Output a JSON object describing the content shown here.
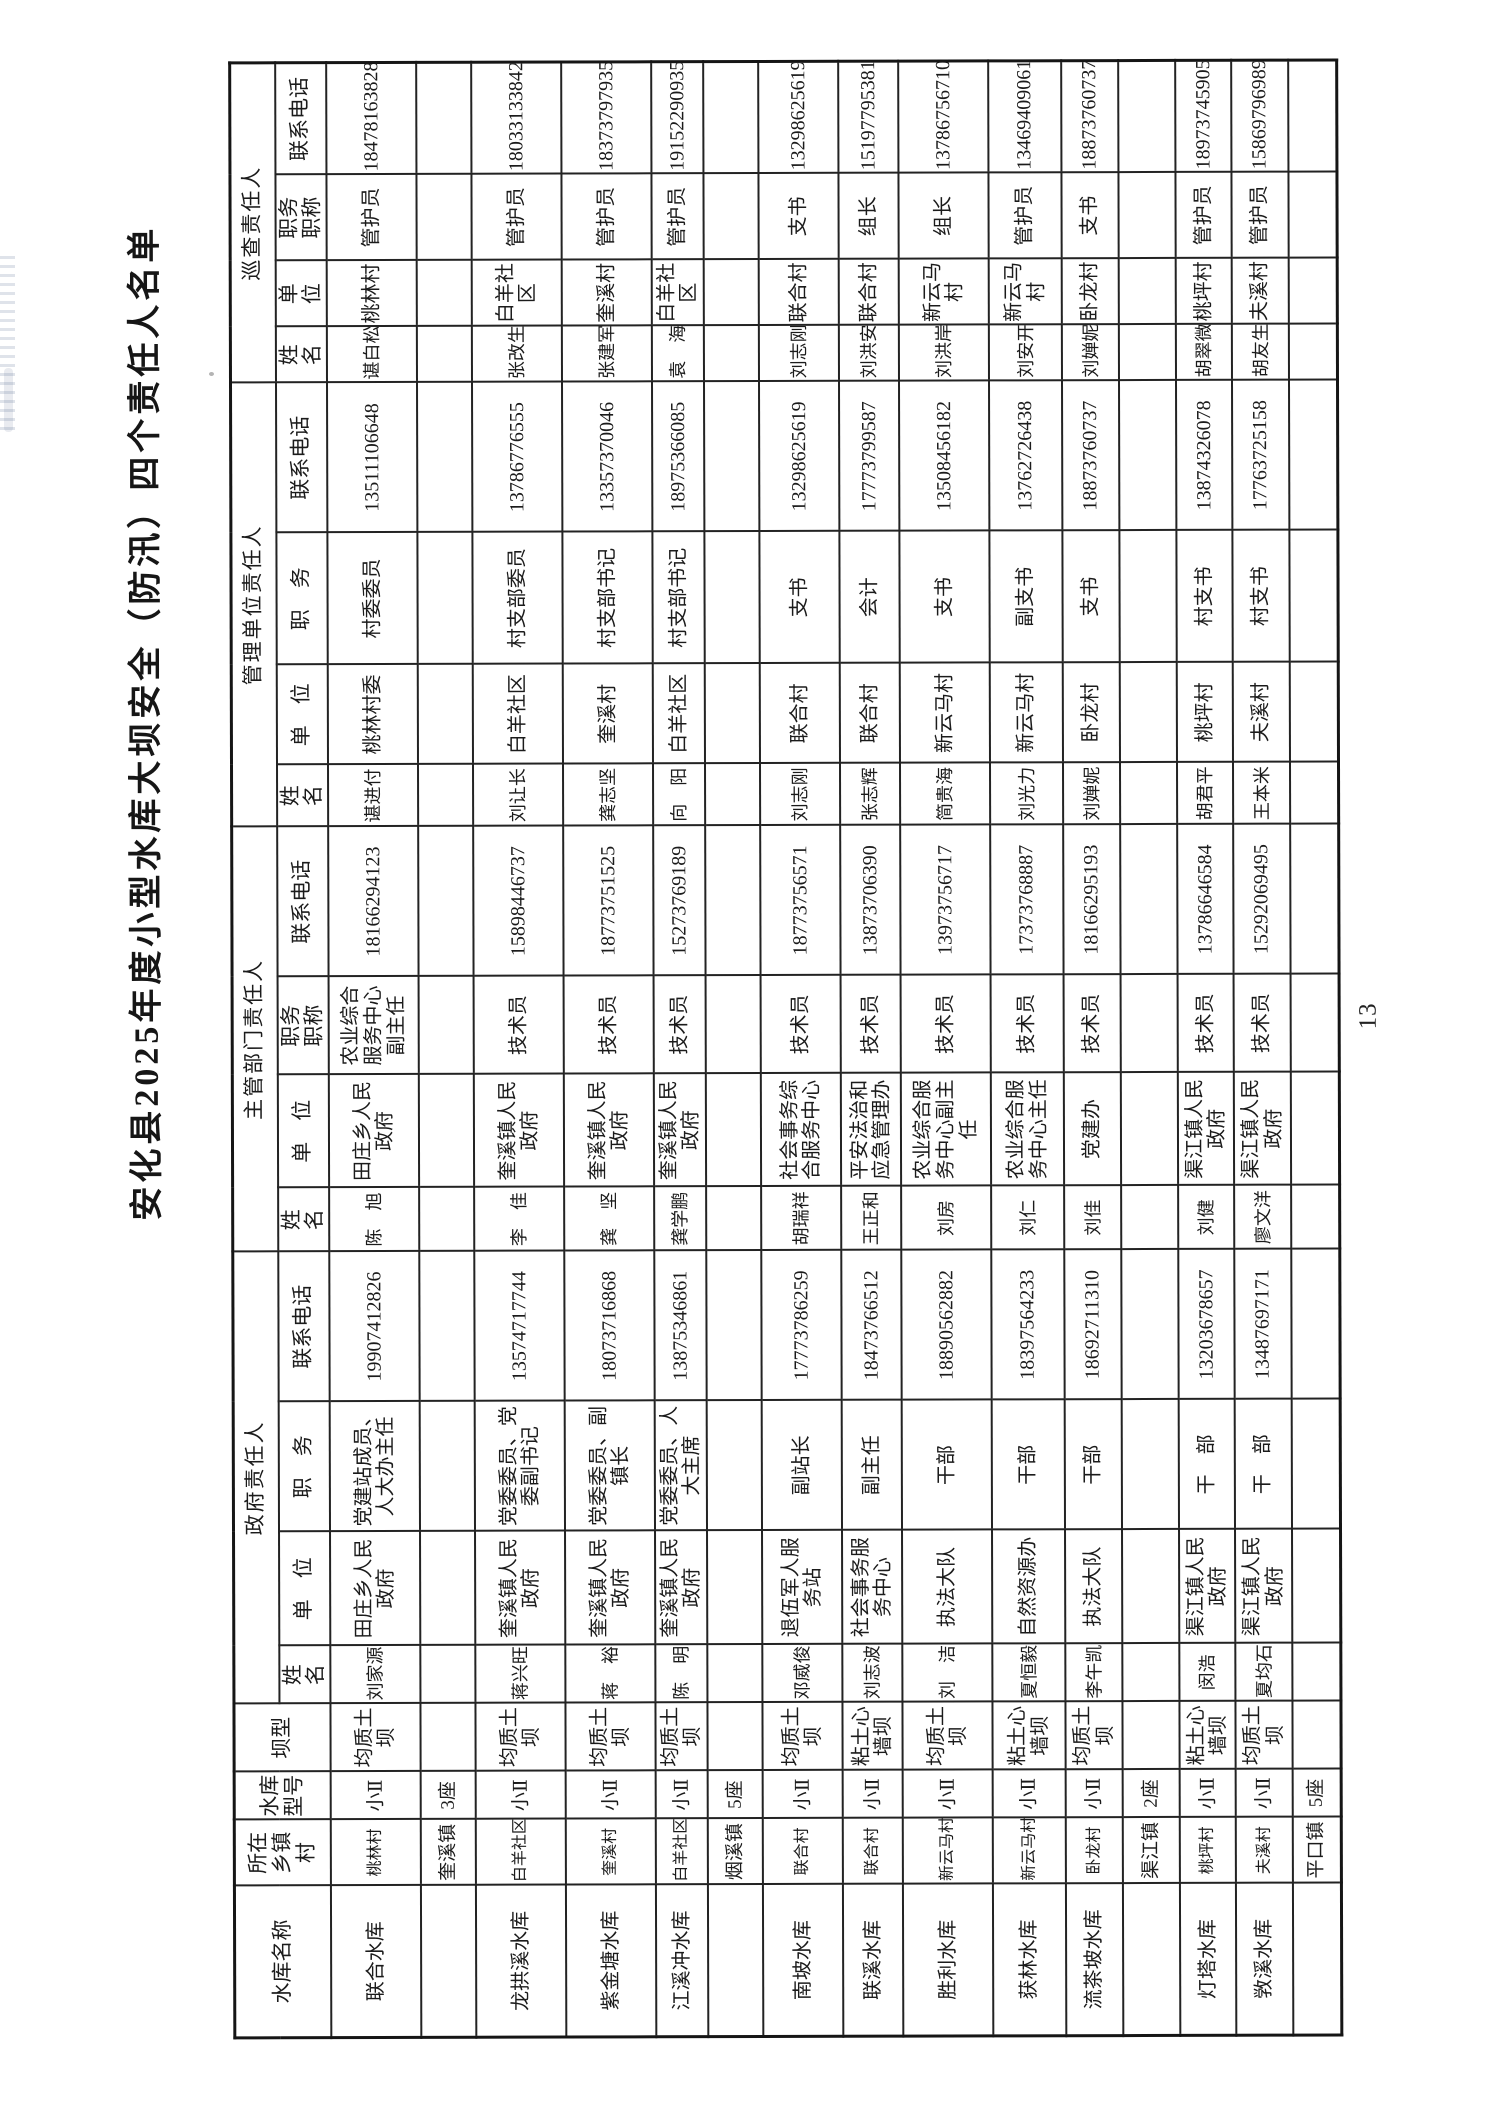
{
  "page": {
    "title": "安化县2025年度小型水库大坝安全（防汛）四个责任人名单",
    "page_number": "13"
  },
  "table": {
    "fixed_headers": [
      "水库名称",
      "所在\n乡镇村",
      "水库\n型号",
      "坝型"
    ],
    "groups": [
      {
        "label": "政府责任人",
        "cols": [
          "姓　名",
          "单　位",
          "职　务",
          "联系电话"
        ]
      },
      {
        "label": "主管部门责任人",
        "cols": [
          "姓　名",
          "单　位",
          "职务\n职称",
          "联系电话"
        ]
      },
      {
        "label": "管理单位责任人",
        "cols": [
          "姓　名",
          "单　位",
          "职　务",
          "联系电话"
        ]
      },
      {
        "label": "巡查责任人",
        "cols": [
          "姓　名",
          "单　位",
          "职务\n职称",
          "联系电话"
        ]
      }
    ],
    "rows": [
      {
        "type": "data",
        "cells": [
          "联合水库",
          "桃林村",
          "小Ⅱ",
          "均质土坝",
          "刘家源",
          "田庄乡人民政府",
          "党建站成员、人大办主任",
          "19907412826",
          "陈　旭",
          "田庄乡人民政府",
          "农业综合服务中心副主任",
          "18166294123",
          "谌进付",
          "桃林村委",
          "村委委员",
          "13511106648",
          "谌白松",
          "桃林村",
          "管护员",
          "18478163828"
        ]
      },
      {
        "type": "group",
        "township": "奎溪镇",
        "count": "3座"
      },
      {
        "type": "data",
        "cells": [
          "龙拱溪水库",
          "白羊社区",
          "小Ⅱ",
          "均质土坝",
          "蒋兴旺",
          "奎溪镇人民政府",
          "党委委员、党委副书记",
          "13574717744",
          "李　佳",
          "奎溪镇人民政府",
          "技术员",
          "15898446737",
          "刘让长",
          "白羊社区",
          "村支部委员",
          "13786776555",
          "张改生",
          "白羊社区",
          "管护员",
          "18033133842"
        ]
      },
      {
        "type": "data",
        "cells": [
          "紫金塘水库",
          "奎溪村",
          "小Ⅱ",
          "均质土坝",
          "蒋　裕",
          "奎溪镇人民政府",
          "党委委员、副镇长",
          "18073716868",
          "龚　坚",
          "奎溪镇人民政府",
          "技术员",
          "18773751525",
          "龚志坚",
          "奎溪村",
          "村支部书记",
          "13357370046",
          "张建军",
          "奎溪村",
          "管护员",
          "18373797935"
        ]
      },
      {
        "type": "data",
        "cells": [
          "江溪冲水库",
          "白羊社区",
          "小Ⅱ",
          "均质土坝",
          "陈　明",
          "奎溪镇人民政府",
          "党委委员、人大主席",
          "13875346861",
          "龚学鹏",
          "奎溪镇人民政府",
          "技术员",
          "15273769189",
          "向　阳",
          "白羊社区",
          "村支部书记",
          "18975366085",
          "袁　海",
          "白羊社区",
          "管护员",
          "19152290935"
        ]
      },
      {
        "type": "group",
        "township": "烟溪镇",
        "count": "5座"
      },
      {
        "type": "data",
        "cells": [
          "南坡水库",
          "联合村",
          "小Ⅱ",
          "均质土坝",
          "邓威俊",
          "退伍军人服务站",
          "副站长",
          "17773786259",
          "胡瑞祥",
          "社会事务综合服务中心",
          "技术员",
          "18773756571",
          "刘志刚",
          "联合村",
          "支书",
          "13298625619",
          "刘志刚",
          "联合村",
          "支书",
          "13298625619"
        ]
      },
      {
        "type": "data",
        "cells": [
          "联溪水库",
          "联合村",
          "小Ⅱ",
          "粘土心墙坝",
          "刘志波",
          "社会事务服务中心",
          "副主任",
          "18473766512",
          "王正和",
          "平安法治和应急管理办",
          "技术员",
          "13873706390",
          "张志辉",
          "联合村",
          "会计",
          "17773799587",
          "刘洪安",
          "联合村",
          "组长",
          "15197795381"
        ]
      },
      {
        "type": "data",
        "cells": [
          "胜利水库",
          "新云马村",
          "小Ⅱ",
          "均质土坝",
          "刘　洁",
          "执法大队",
          "干部",
          "18890562882",
          "刘房",
          "农业综合服务中心副主任",
          "技术员",
          "13973756717",
          "简贵海",
          "新云马村",
          "支书",
          "13508456182",
          "刘洪岸",
          "新云马村",
          "组长",
          "13786756710"
        ]
      },
      {
        "type": "data",
        "cells": [
          "获林水库",
          "新云马村",
          "小Ⅱ",
          "粘土心墙坝",
          "夏恒毅",
          "自然资源办",
          "干部",
          "18397564233",
          "刘仁",
          "农业综合服务中心主任",
          "技术员",
          "17373768887",
          "刘光力",
          "新云马村",
          "副支书",
          "13762726438",
          "刘安开",
          "新云马村",
          "管护员",
          "13469409061"
        ]
      },
      {
        "type": "data",
        "cells": [
          "流茶坡水库",
          "卧龙村",
          "小Ⅱ",
          "均质土坝",
          "李午凯",
          "执法大队",
          "干部",
          "18692711310",
          "刘佳",
          "党建办",
          "技术员",
          "18166295193",
          "刘婵妮",
          "卧龙村",
          "支书",
          "18873760737",
          "刘婵妮",
          "卧龙村",
          "支书",
          "18873760737"
        ]
      },
      {
        "type": "group",
        "township": "渠江镇",
        "count": "2座"
      },
      {
        "type": "data",
        "cells": [
          "灯塔水库",
          "桃坪村",
          "小Ⅱ",
          "粘土心墙坝",
          "闵浩",
          "渠江镇人民政府",
          "干　部",
          "13203678657",
          "刘健",
          "渠江镇人民政府",
          "技术员",
          "13786646584",
          "胡君平",
          "桃坪村",
          "村支书",
          "13874326078",
          "胡翠微",
          "桃坪村",
          "管护员",
          "18973745905"
        ]
      },
      {
        "type": "data",
        "cells": [
          "敩溪水库",
          "夫溪村",
          "小Ⅱ",
          "均质土坝",
          "夏均石",
          "渠江镇人民政府",
          "干　部",
          "13487697171",
          "廖文洋",
          "渠江镇人民政府",
          "技术员",
          "15292069495",
          "王本米",
          "夫溪村",
          "村支书",
          "17763725158",
          "胡友生",
          "夫溪村",
          "管护员",
          "15869796989"
        ]
      },
      {
        "type": "group",
        "township": "平口镇",
        "count": "5座"
      }
    ]
  }
}
